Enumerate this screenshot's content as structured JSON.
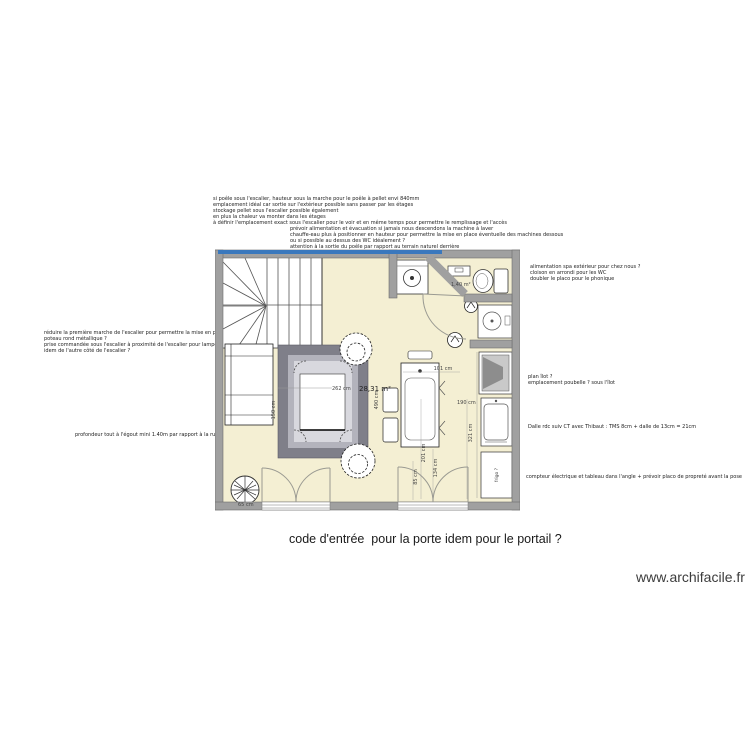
{
  "app": {
    "watermark": "www.archifacile.fr"
  },
  "caption": "code d'entrée  pour la porte idem pour le portail ?",
  "room": {
    "area": "28,31 m²",
    "wc_area": "1,40 m²"
  },
  "dims": {
    "w101": "101 cm",
    "w190": "190 cm",
    "w321": "321 cm",
    "w201": "201 cm",
    "w134": "134 cm",
    "w85": "85 cm",
    "w490": "490 cm",
    "w150": "150 cm",
    "w262": "262 cm",
    "w65": "65 cm"
  },
  "labels": {
    "fridge": "frigo ?"
  },
  "notes": {
    "pellet": [
      "si poêle sous l'escalier, hauteur sous la marche pour le poêle à pellet envi 840mm",
      "emplacement idéal car sortie sur l'extérieur possible sans passer par les étages",
      "stockage pellet sous l'escalier possible également",
      "en plus la chaleur va monter dans les étages",
      "à définir l'emplacement exact sous l'escalier pour le voir et en même temps pour permettre le remplissage et l'accès"
    ],
    "machine": [
      "prévoir alimentation et évacuation si jamais nous descendons la machine à laver",
      "chauffe-eau plus à positionner en hauteur pour permettre la mise en place éventuelle des machines dessous",
      "ou si possible au dessus des WC idéalement ?",
      "attention à la sortie du poêle par rapport au terrain naturel derrière"
    ],
    "spa": [
      "alimentation spa extérieur pour chez nous ?",
      "cloison en arrondi pour les WC",
      "doubler le placo pour le phonique"
    ],
    "ilot": [
      "plan îlot ?",
      "emplacement poubelle ? sous l'îlot"
    ],
    "dalle": "Dalle rdc suiv CT avec Thibaut : TMS 8cm + dalle de 13cm = 21cm",
    "compteur": "compteur électrique et tableau dans l'angle + prévoir placo de propreté avant la pose",
    "escalier": [
      "réduire la première marche de l'escalier pour permettre la mise en place du poteau",
      "poteau rond métallique ?",
      "prise commandée sous l'escalier à proximité de l'escalier pour lampe ?",
      "idem de l'autre côté de l'escalier ?"
    ],
    "egout": "profondeur tout à l'égout mini 1.40m par rapport à la rue"
  },
  "colors": {
    "wall": "#a0a0a0",
    "floor": "#f4efd3",
    "selected_wall": "#3a78bd"
  }
}
